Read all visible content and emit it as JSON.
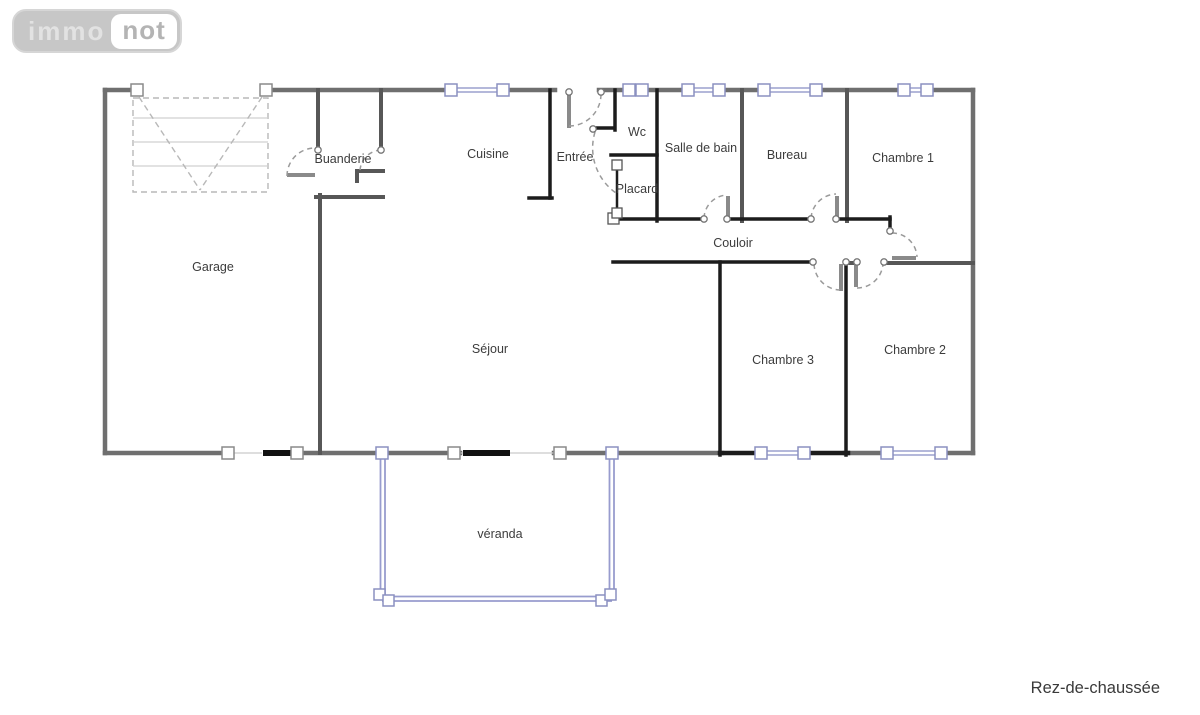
{
  "logo": {
    "part1": "immo",
    "part2": "not"
  },
  "floor_label": "Rez-de-chaussée",
  "rooms": [
    {
      "label": "Garage"
    },
    {
      "label": "Buanderie"
    },
    {
      "label": "Cuisine"
    },
    {
      "label": "Entrée"
    },
    {
      "label": "Wc"
    },
    {
      "label": "Salle de bain"
    },
    {
      "label": "Bureau"
    },
    {
      "label": "Chambre 1"
    },
    {
      "label": "Placard"
    },
    {
      "label": "Couloir"
    },
    {
      "label": "Séjour"
    },
    {
      "label": "Chambre 3"
    },
    {
      "label": "Chambre 2"
    },
    {
      "label": "véranda"
    }
  ],
  "colors": {
    "outer_wall": "#6f6f6f",
    "secondary_wall": "#575757",
    "interior_wall": "#1c1c1c",
    "door_leaf": "#8a8a8a",
    "door_arc": "#9a9a9a",
    "window_frame": "#9ba0ce",
    "veranda_wall": "#989cce",
    "garage_door_symbol": "#b8b8b8",
    "label_text": "#3c3c3c",
    "logo_background": "#c7c7c7",
    "logo_text_light": "#e2e2e2",
    "logo_text_dark": "#b4b4b4"
  }
}
